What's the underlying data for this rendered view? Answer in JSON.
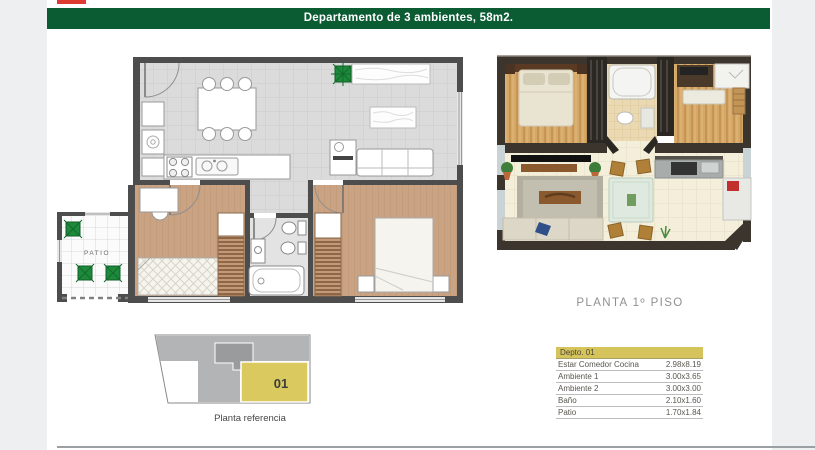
{
  "header": {
    "title": "Departamento de 3 ambientes, 58m2."
  },
  "colors": {
    "header_green": "#0b5b33",
    "logo_red": "#dd3a30",
    "unit_highlight_yellow": "#d9c95f",
    "table_header_yellow": "#d5c35c",
    "wall_gray": "#4d4d4d",
    "plant_green": "#1c8a3a",
    "bedroom_floor_tan": "#c9a383"
  },
  "plan2d": {
    "patio_label": "PATIO"
  },
  "plan3d": {
    "caption": "PLANTA 1º PISO"
  },
  "reference": {
    "unit_label": "01",
    "caption": "Planta referencia"
  },
  "dims_table": {
    "header": "Depto. 01",
    "rows": [
      {
        "name": "Estar Comedor Cocina",
        "dims": "2.98x8.19"
      },
      {
        "name": "Ambiente 1",
        "dims": "3.00x3.65"
      },
      {
        "name": "Ambiente 2",
        "dims": "3.00x3.00"
      },
      {
        "name": "Baño",
        "dims": "2.10x1.60"
      },
      {
        "name": "Patio",
        "dims": "1.70x1.84"
      }
    ]
  }
}
